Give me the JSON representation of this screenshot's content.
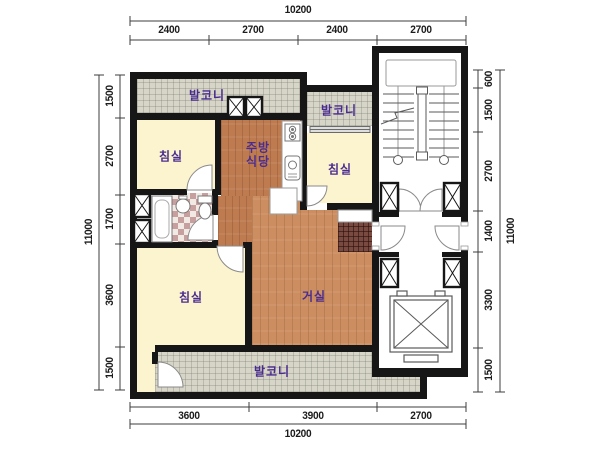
{
  "drawing": {
    "type": "apartment-floor-plan",
    "units": "mm"
  },
  "dimensions": {
    "top": {
      "total": "10200",
      "segments": [
        "2400",
        "2700",
        "2400",
        "2700"
      ]
    },
    "bottom": {
      "total": "10200",
      "segments": [
        "3600",
        "3900",
        "2700"
      ]
    },
    "left": {
      "total": "11000",
      "segments": [
        "1500",
        "2700",
        "1700",
        "3600",
        "1500"
      ]
    },
    "right": {
      "total": "11000",
      "segments": [
        "600",
        "1500",
        "2700",
        "1400",
        "3300",
        "1500"
      ]
    }
  },
  "rooms": {
    "balcony_top": {
      "label": "발코니"
    },
    "balcony_upper_right": {
      "label": "발코니"
    },
    "bedroom_top_left": {
      "label": "침실"
    },
    "kitchen_dining": {
      "label_line1": "주방",
      "label_line2": "식당"
    },
    "bedroom_right": {
      "label": "침실"
    },
    "bedroom_bottom_left": {
      "label": "침실"
    },
    "living_room": {
      "label": "거실"
    },
    "balcony_bottom": {
      "label": "발코니"
    }
  },
  "icons": {
    "stairs": "stairs-icon",
    "elevator": "elevator-icon",
    "bathtub": "bathtub-icon",
    "washbasin": "washbasin-icon",
    "toilet": "toilet-icon",
    "stove": "stove-icon",
    "kitchen_sink": "kitchen-sink-icon",
    "closet": "closet-x-icon",
    "door": "door-swing-icon"
  },
  "colors": {
    "wall": "#161616",
    "room_label": "#4a2c90",
    "bedroom_floor": "#fcf4cf",
    "kitchen_floor": "#bf7b50",
    "living_floor": "#cc8e60",
    "balcony_tile": "#d6d5c7",
    "entry_tile": "#7a4a41",
    "bath_tile": "#c79f9f",
    "window": "#d9d9d9",
    "dimension_text": "#1c1c1c"
  }
}
